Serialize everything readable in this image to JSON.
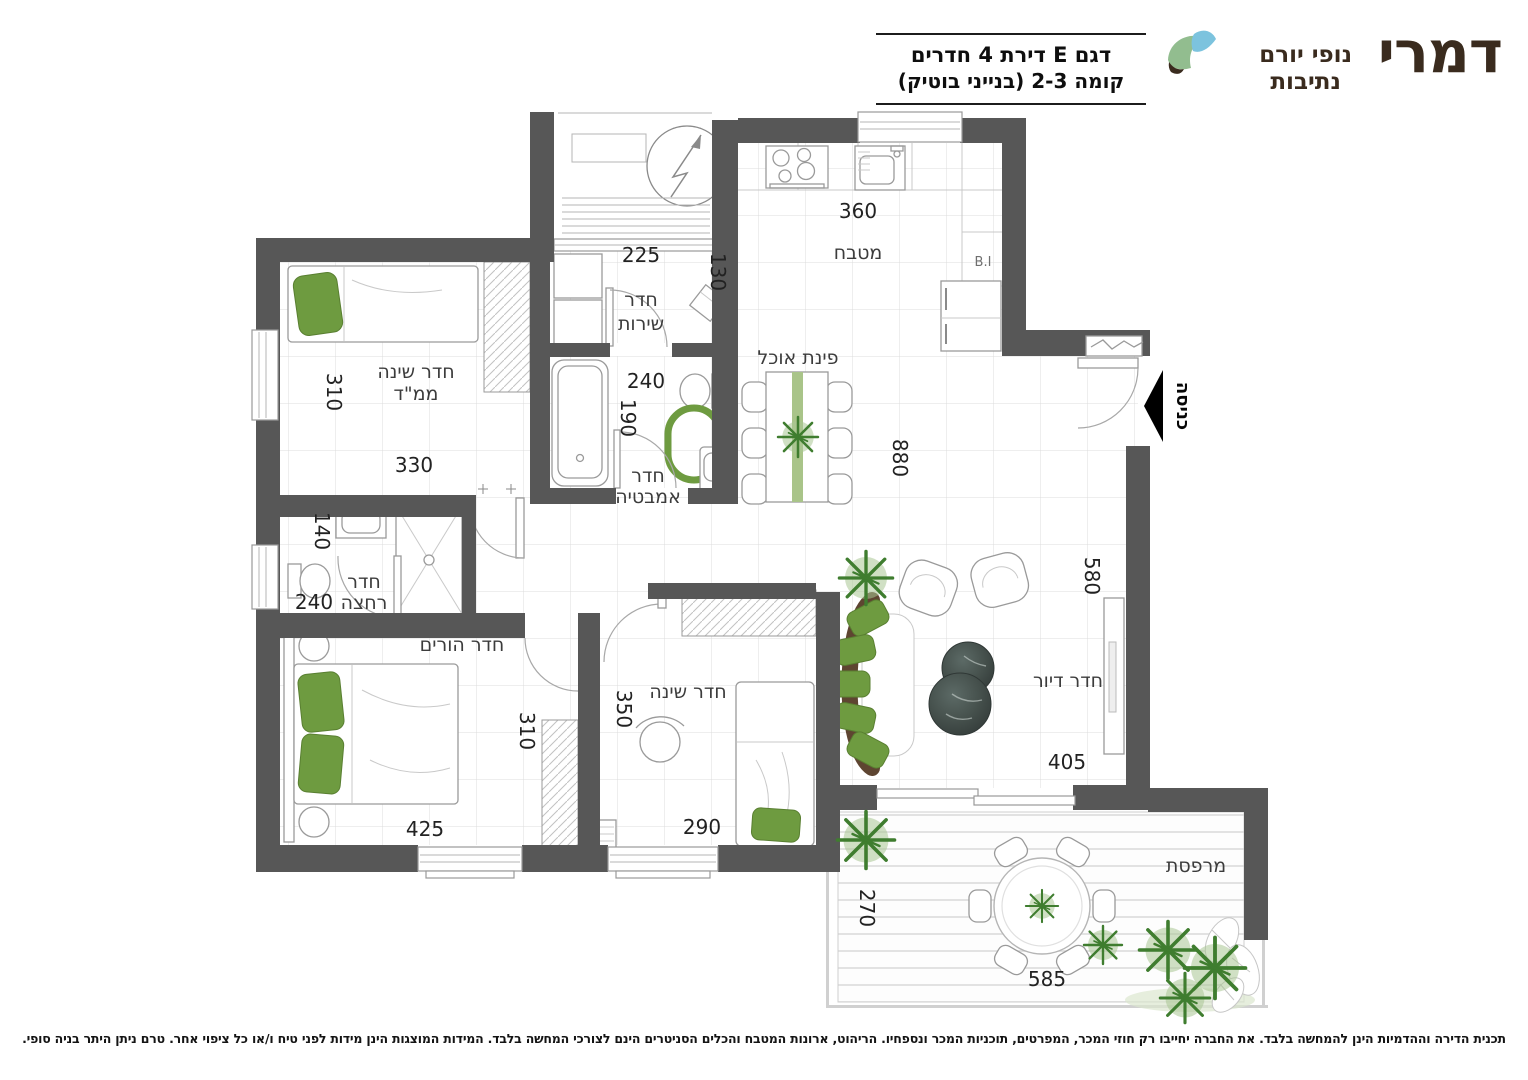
{
  "brand": {
    "name": "דמרי",
    "sub1": "נופי יורם",
    "sub2": "נתיבות"
  },
  "title": {
    "line1": "דגם E דירת 4 חדרים",
    "line2": "קומה 2-3 (בנייני בוטיק)"
  },
  "rooms": {
    "kitchen": "מטבח",
    "dining": "פינת אוכל",
    "mamad_l1": "חדר שינה",
    "mamad_l2": "ממ\"ד",
    "service_l1": "חדר",
    "service_l2": "שירות",
    "bath_l1": "חדר",
    "bath_l2": "אמבטיה",
    "shower_l1": "חדר",
    "shower_l2": "רחצה",
    "parents": "חדר הורים",
    "bedroom": "חדר שינה",
    "living": "חדר דיור",
    "balcony": "מרפסת",
    "entrance": "כניסה",
    "builtin": "B.I"
  },
  "dims": {
    "kitchen_w": "360",
    "service_w": "225",
    "service_d": "130",
    "bath_w": "240",
    "bath_h": "190",
    "mamad_h": "310",
    "mamad_w": "330",
    "wc_h": "140",
    "wc_w": "240",
    "dining_h": "880",
    "living_h": "580",
    "living_w": "405",
    "parents_w": "425",
    "parents_h": "310",
    "bedroom_h": "350",
    "bedroom_w": "290",
    "balcony_h": "270",
    "balcony_w": "585"
  },
  "footer": {
    "disclaimer": "תכנית הדירה וההדמיות הינן להמחשה בלבד. את החברה יחייבו רק חוזי המכר, המפרטים, תוכניות המכר ונספחיו. הריהוט, ארונות המטבח והכלים הסניטרים הינם לצורכי המחשה בלבד. המידות המוצגות הינן מידות לפני טיח ו/או כל ציפוי אחר. טרם ניתן היתר בניה סופי."
  }
}
